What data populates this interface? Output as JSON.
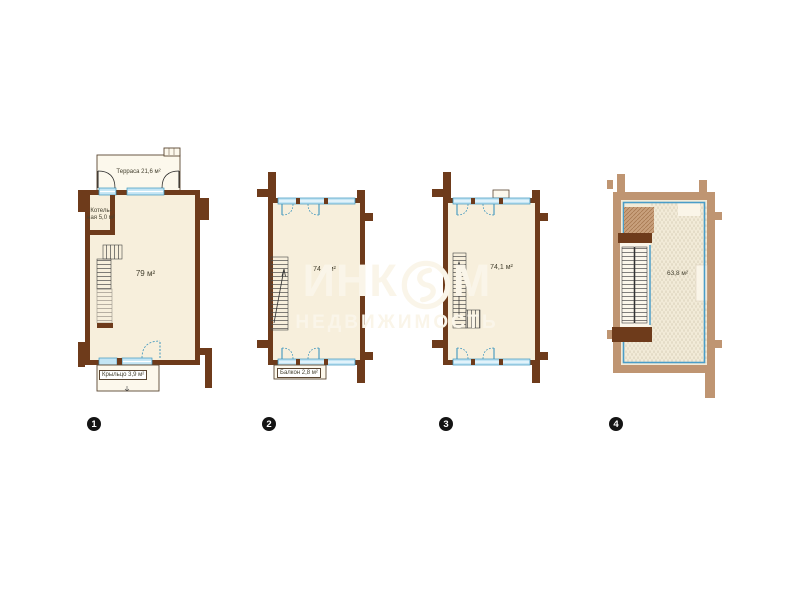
{
  "watermark": {
    "brand_prefix": "ИНК",
    "brand_suffix": "М",
    "subtitle": "НЕДВИЖИМОСТЬ"
  },
  "plans": [
    {
      "number": "1",
      "labels": {
        "terrace": "Терраса 21,6 м²",
        "boiler_line1": "Котель-",
        "boiler_line2": "ная 5,0 м²",
        "area": "79 м²",
        "porch": "Крыльцо 3,9 м²"
      }
    },
    {
      "number": "2",
      "labels": {
        "area": "74,4 м²",
        "balcony": "Балкон 2,8 м²"
      }
    },
    {
      "number": "3",
      "labels": {
        "area": "74,1 м²"
      }
    },
    {
      "number": "4",
      "labels": {
        "area": "63,8 м²"
      }
    }
  ],
  "colors": {
    "wall_brown": "#6e3b1b",
    "wall_tan": "#bf9572",
    "floor_cream": "#f7efdc",
    "annex_cream": "#fcf8ec",
    "window_blue": "#c3e5f4",
    "window_frame": "#3e96be",
    "roofline_blue": "#4a9dc8",
    "badge_black": "#141414",
    "watermark_cream": "#faf5e9"
  }
}
